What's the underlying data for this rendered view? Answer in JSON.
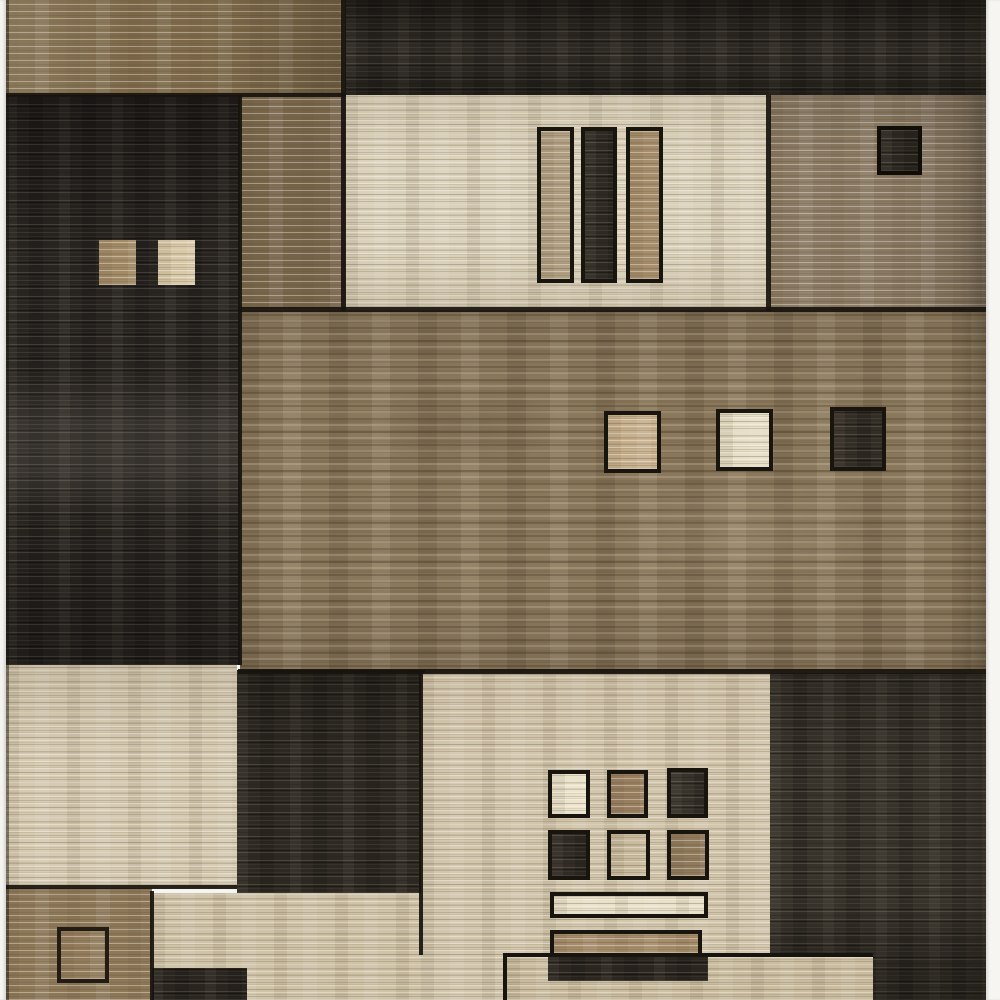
{
  "scene": {
    "type": "product-photo",
    "subject": "modern abstract geometric area rug",
    "pattern": "patchwork of rectangles and small accent squares in brown, beige, cream and charcoal with horizontal heathered weave texture",
    "background": "white seamless backdrop"
  },
  "palette": {
    "photo_background": "#f6f5f2",
    "seam_dark": "#17130e",
    "top_left_brown": "#7e6a4a",
    "top_dark_strip": "#2f2b25",
    "left_dark_block": "#282420",
    "left_sq_tan": "#a28a66",
    "left_sq_beige": "#d8caa9",
    "mid_top_brown": "#77654a",
    "cream_block": "#dbd2bb",
    "cream_bar_tan1": "#b1a083",
    "cream_bar_dark": "#2e2a23",
    "cream_bar_tan2": "#a68e6c",
    "right_top_brown": "#8a7a63",
    "right_sq_dark": "#2c2821",
    "field_brown": "#8a785c",
    "field_sq_tan": "#c7b08d",
    "field_sq_cream": "#e7dfc7",
    "field_sq_dark": "#322d25",
    "bottom_left_cream": "#d6cbb2",
    "bottom_mid_dark": "#2d2922",
    "bottom_left_brown": "#8d7858",
    "bottom_brown_sq": "#927c5b",
    "bottom_beige": "#d2c6ac",
    "lower_beige": "#cfc3a8",
    "grid_sq_cream": "#ece4cd",
    "grid_sq_brown": "#997f60",
    "grid_sq_dark1": "#37322a",
    "grid_sq_dark2": "#302b24",
    "grid_sq_beige": "#c9bb9d",
    "grid_sq_brown2": "#8f7a5b",
    "bar_cream": "#e9e1ca",
    "bar_tan": "#a58d6b",
    "bar_dark": "#2b2620",
    "beige_strip": "#c9bc9f",
    "bottom_right_dark": "#37322a",
    "bottom_dark_rect": "#2a251f"
  },
  "regions": [
    {
      "name": "top-left-brown-block",
      "fill": "top_left_brown"
    },
    {
      "name": "top-dark-strip",
      "fill": "top_dark_strip"
    },
    {
      "name": "left-dark-block",
      "fill": "left_dark_block",
      "accents": [
        "left_sq_tan",
        "left_sq_beige"
      ]
    },
    {
      "name": "mid-top-brown-block",
      "fill": "mid_top_brown"
    },
    {
      "name": "cream-block",
      "fill": "cream_block",
      "accents": [
        "cream_bar_tan1",
        "cream_bar_dark",
        "cream_bar_tan2"
      ]
    },
    {
      "name": "right-top-brown-block",
      "fill": "right_top_brown",
      "accents": [
        "right_sq_dark"
      ]
    },
    {
      "name": "center-brown-field",
      "fill": "field_brown",
      "accents": [
        "field_sq_tan",
        "field_sq_cream",
        "field_sq_dark"
      ]
    },
    {
      "name": "bottom-left-cream-block",
      "fill": "bottom_left_cream"
    },
    {
      "name": "bottom-mid-dark-block",
      "fill": "bottom_mid_dark"
    },
    {
      "name": "bottom-left-brown-block",
      "fill": "bottom_left_brown",
      "accents": [
        "bottom_brown_sq"
      ]
    },
    {
      "name": "bottom-center-beige-block",
      "fill": "bottom_beige",
      "accents": [
        "grid_sq_cream",
        "grid_sq_brown",
        "grid_sq_dark1",
        "grid_sq_dark2",
        "grid_sq_beige",
        "grid_sq_brown2",
        "bar_cream",
        "bar_tan",
        "bar_dark"
      ]
    },
    {
      "name": "bottom-right-dark-block",
      "fill": "bottom_right_dark"
    },
    {
      "name": "bottom-beige-strip",
      "fill": "beige_strip"
    },
    {
      "name": "bottom-dark-rect",
      "fill": "bottom_dark_rect"
    }
  ]
}
